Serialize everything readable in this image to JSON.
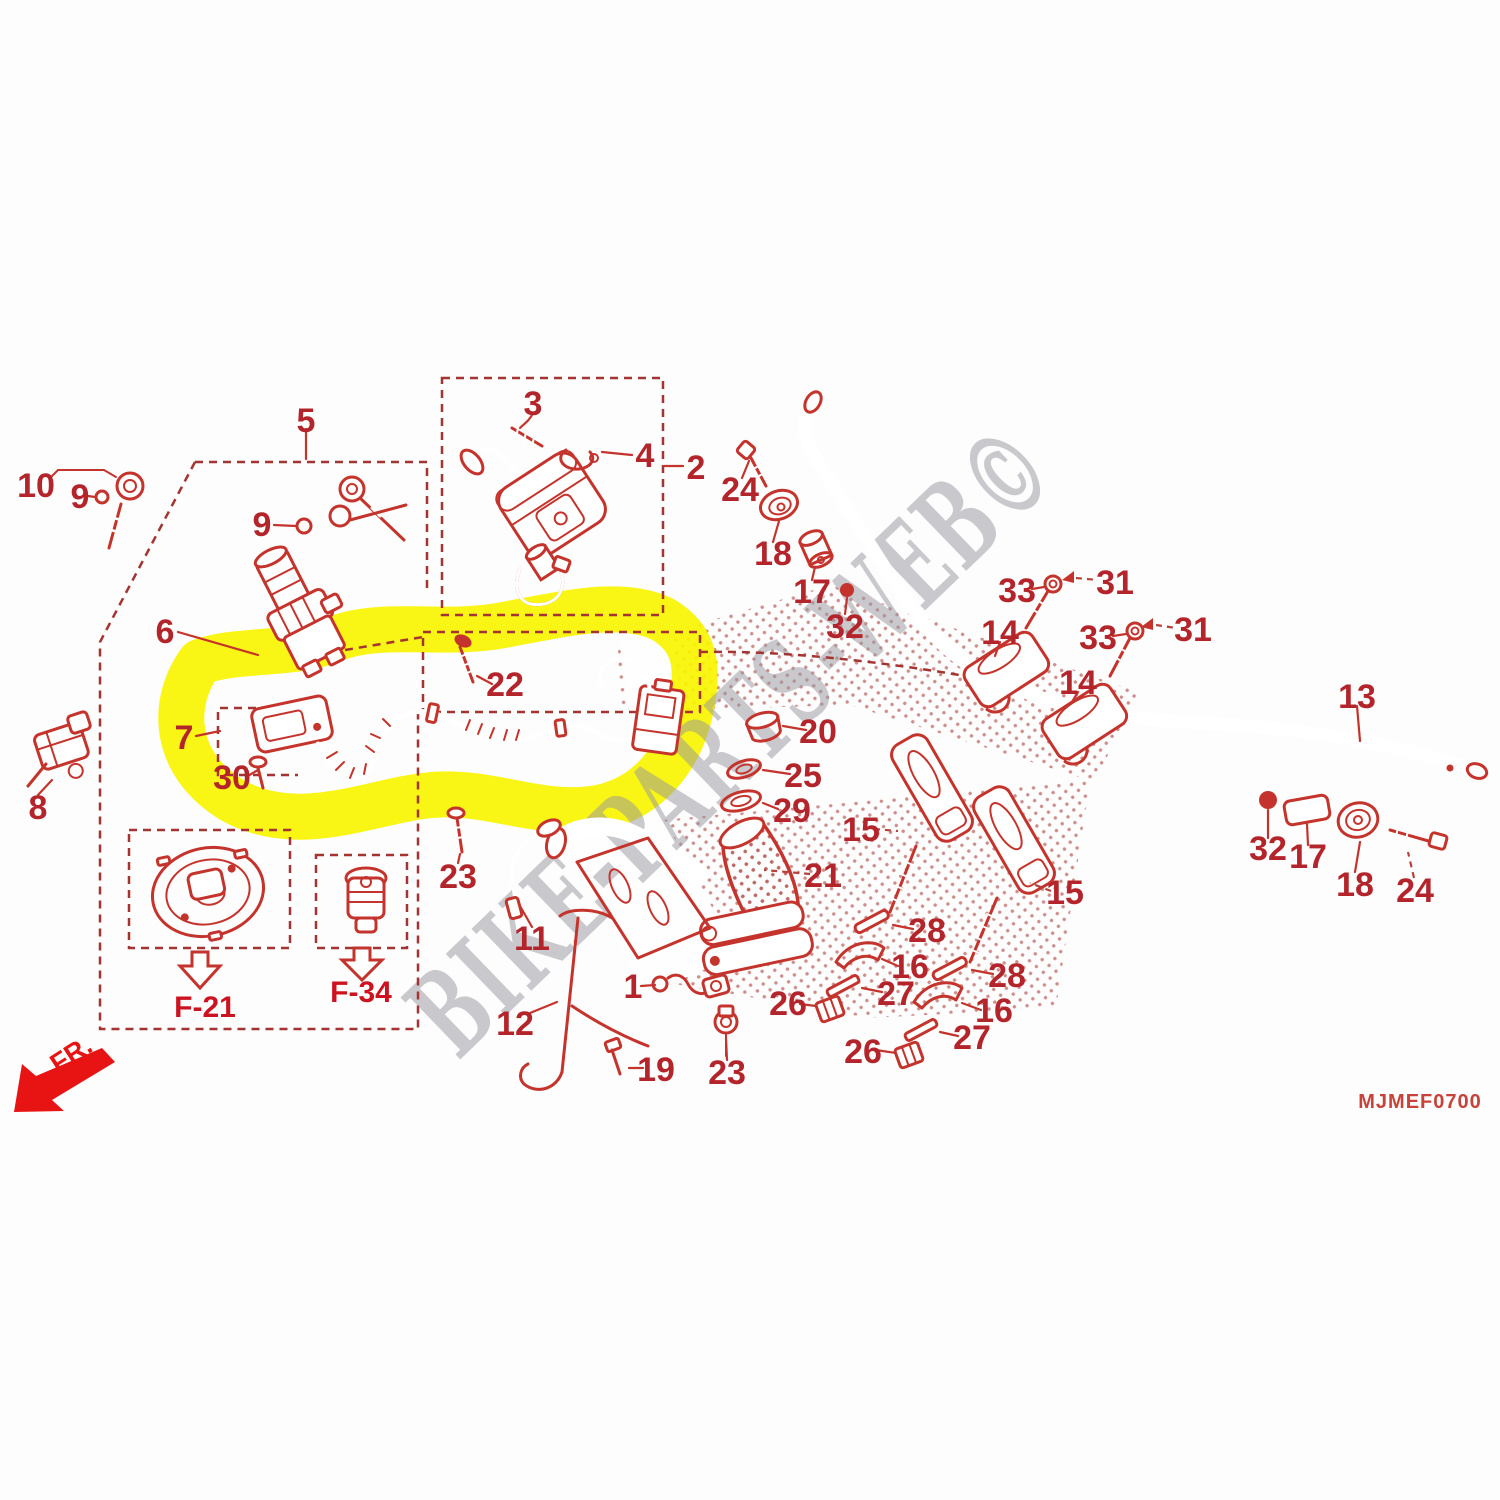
{
  "diagram": {
    "watermark": "BIKE-PARTS-WEB©",
    "code": "MJMEF0700",
    "direction_label": "FR.",
    "highlight_color": "#f8f400",
    "line_color": "#c5342c",
    "label_color": "#b3252b",
    "ref_f21": "F-21",
    "ref_f34": "F-34"
  },
  "callouts": [
    {
      "label": "1",
      "x": 633,
      "y": 986
    },
    {
      "label": "2",
      "x": 696,
      "y": 467
    },
    {
      "label": "3",
      "x": 533,
      "y": 403
    },
    {
      "label": "4",
      "x": 645,
      "y": 455
    },
    {
      "label": "5",
      "x": 306,
      "y": 420
    },
    {
      "label": "6",
      "x": 165,
      "y": 631
    },
    {
      "label": "7",
      "x": 184,
      "y": 737
    },
    {
      "label": "8",
      "x": 38,
      "y": 807
    },
    {
      "label": "9",
      "x": 80,
      "y": 496
    },
    {
      "label": "9",
      "x": 262,
      "y": 524
    },
    {
      "label": "10",
      "x": 36,
      "y": 485
    },
    {
      "label": "11",
      "x": 532,
      "y": 938
    },
    {
      "label": "12",
      "x": 515,
      "y": 1023
    },
    {
      "label": "13",
      "x": 1357,
      "y": 696
    },
    {
      "label": "14",
      "x": 1000,
      "y": 632
    },
    {
      "label": "14",
      "x": 1078,
      "y": 682
    },
    {
      "label": "15",
      "x": 861,
      "y": 829
    },
    {
      "label": "15",
      "x": 1065,
      "y": 892
    },
    {
      "label": "16",
      "x": 910,
      "y": 966
    },
    {
      "label": "16",
      "x": 994,
      "y": 1010
    },
    {
      "label": "17",
      "x": 812,
      "y": 591
    },
    {
      "label": "17",
      "x": 1308,
      "y": 856
    },
    {
      "label": "18",
      "x": 773,
      "y": 553
    },
    {
      "label": "18",
      "x": 1355,
      "y": 884
    },
    {
      "label": "19",
      "x": 656,
      "y": 1069
    },
    {
      "label": "20",
      "x": 818,
      "y": 731
    },
    {
      "label": "21",
      "x": 823,
      "y": 875
    },
    {
      "label": "22",
      "x": 505,
      "y": 684
    },
    {
      "label": "23",
      "x": 458,
      "y": 876
    },
    {
      "label": "23",
      "x": 727,
      "y": 1072
    },
    {
      "label": "24",
      "x": 740,
      "y": 489
    },
    {
      "label": "24",
      "x": 1415,
      "y": 890
    },
    {
      "label": "25",
      "x": 803,
      "y": 775
    },
    {
      "label": "26",
      "x": 788,
      "y": 1003
    },
    {
      "label": "26",
      "x": 863,
      "y": 1051
    },
    {
      "label": "27",
      "x": 896,
      "y": 993
    },
    {
      "label": "27",
      "x": 972,
      "y": 1037
    },
    {
      "label": "28",
      "x": 927,
      "y": 930
    },
    {
      "label": "28",
      "x": 1007,
      "y": 975
    },
    {
      "label": "29",
      "x": 792,
      "y": 810
    },
    {
      "label": "30",
      "x": 232,
      "y": 777
    },
    {
      "label": "31",
      "x": 1115,
      "y": 582
    },
    {
      "label": "31",
      "x": 1193,
      "y": 629
    },
    {
      "label": "32",
      "x": 845,
      "y": 626
    },
    {
      "label": "32",
      "x": 1268,
      "y": 848
    },
    {
      "label": "33",
      "x": 1017,
      "y": 590
    },
    {
      "label": "33",
      "x": 1098,
      "y": 637
    }
  ]
}
